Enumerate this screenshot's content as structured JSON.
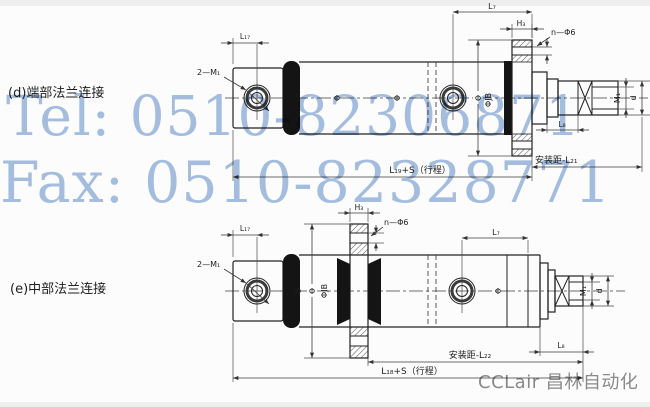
{
  "watermarks": {
    "tel": "Tel: 0510-82306871",
    "fax": "Fax: 0510-82328771",
    "brand": "CCLair 昌林自动化",
    "color": "#a6c0e2",
    "brand_color": "#8c8c8c"
  },
  "figures": [
    {
      "caption": "(d)端部法兰连接",
      "labels": {
        "port_thread": "2—M₁",
        "l17": "L₁₇",
        "l7": "L₇",
        "h3": "H₃",
        "bolt_holes": "n—Φ6",
        "dia": "Φ",
        "flange_dia": "ΦJB",
        "rod_thread": "M₁",
        "rod_dia": "d",
        "l8": "L₈",
        "mount": "安装距-L₂₁",
        "stroke": "L₁₉+S（行程）"
      }
    },
    {
      "caption": "(e)中部法兰连接",
      "labels": {
        "port_thread": "2—M₁",
        "l17": "L₁₇",
        "l7": "L₇",
        "h3": "H₃",
        "bolt_holes": "n—Φ6",
        "dia": "Φ",
        "flange_dia": "ΦJB",
        "rod_thread": "M₁",
        "rod_dia": "d",
        "l8": "L₈",
        "mount": "安装距-L₂₂",
        "stroke": "L₁₈+S（行程）"
      }
    }
  ]
}
